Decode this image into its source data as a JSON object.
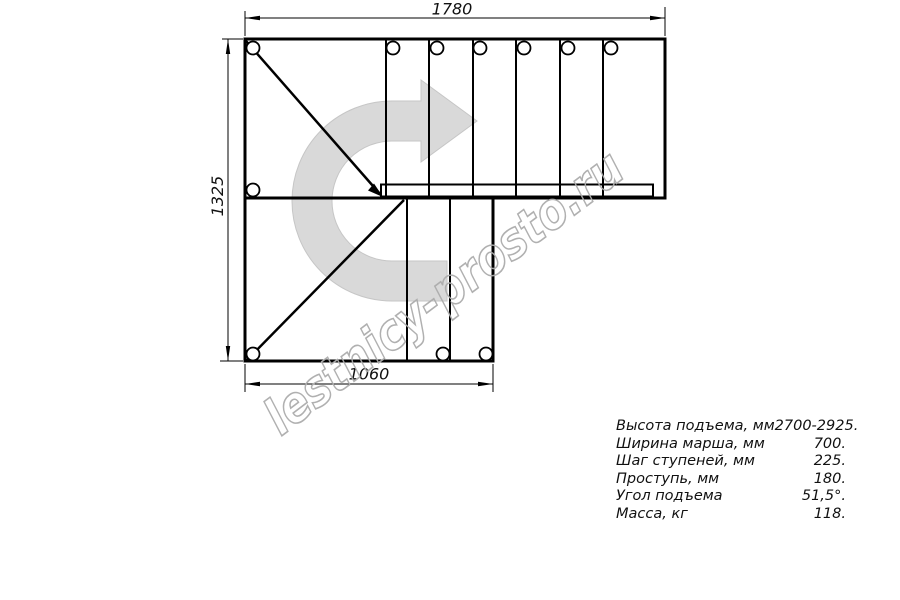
{
  "drawing": {
    "title": "L-shaped staircase plan view",
    "dimensions": {
      "top": "1780",
      "left": "1325",
      "bottom": "1060"
    },
    "colors": {
      "line": "#000000",
      "direction_arrow_fill": "#d9d9d9",
      "direction_arrow_edge": "#c6c6c6",
      "watermark": "#acacac"
    },
    "icons": {
      "direction_arrow": "u-turn-right-curved-arrow"
    }
  },
  "watermark": {
    "text": "lestnicy-prosto.ru"
  },
  "specs": {
    "rows": [
      {
        "label": "Высота подъема, мм",
        "value": "2700-2925."
      },
      {
        "label": "Ширина марша, мм",
        "value": "700."
      },
      {
        "label": "Шаг ступеней, мм",
        "value": "225."
      },
      {
        "label": "Проступь, мм",
        "value": "180."
      },
      {
        "label": "Угол подъема",
        "value": "51,5°."
      },
      {
        "label": "Масса, кг",
        "value": "118."
      }
    ]
  }
}
